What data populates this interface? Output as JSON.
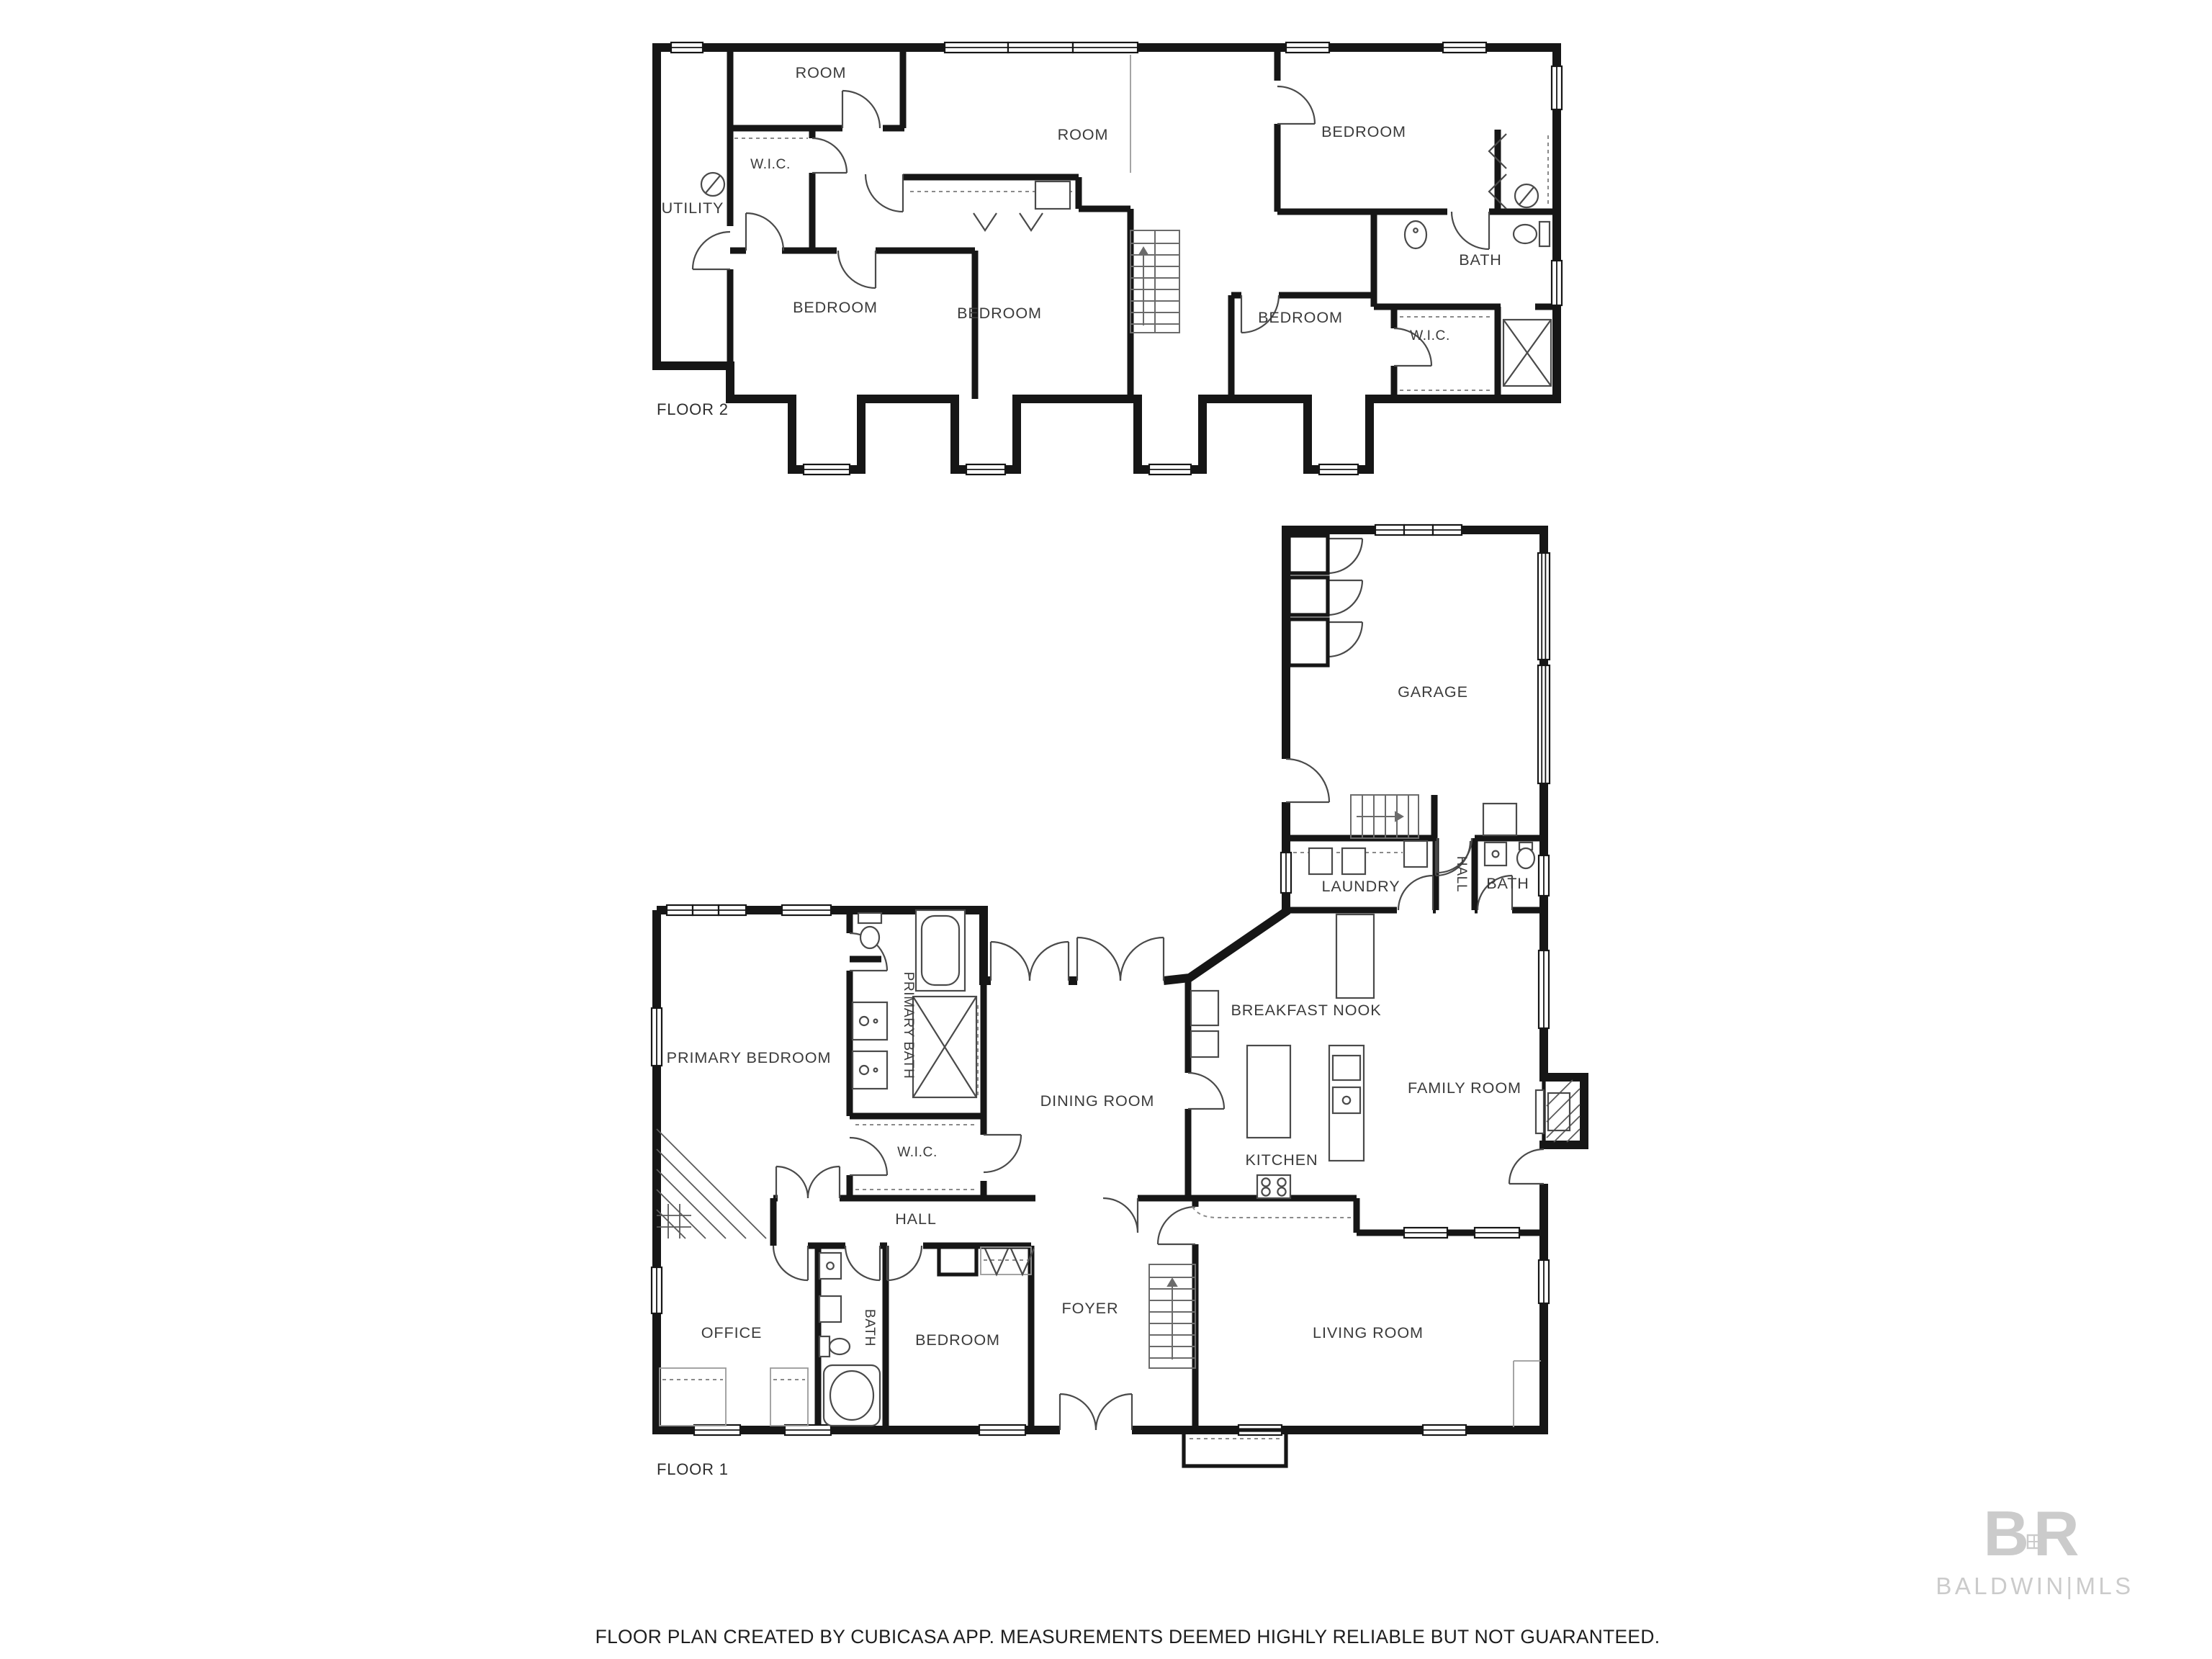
{
  "document": {
    "type": "floor-plan",
    "creator_note": "FLOOR PLAN CREATED BY CUBICASA APP. MEASUREMENTS DEEMED HIGHLY RELIABLE BUT NOT GUARANTEED."
  },
  "colors": {
    "background": "#ffffff",
    "wall": "#161616",
    "label": "#3b3b3b",
    "watermark": "#cbcbcb"
  },
  "floor2": {
    "label": "FLOOR 2",
    "rooms": {
      "utility": "UTILITY",
      "wic_left": "W.I.C.",
      "room_small": "ROOM",
      "room_center": "ROOM",
      "bedroom_top": "BEDROOM",
      "bath": "BATH",
      "wic_right": "W.I.C.",
      "bedroom_left": "BEDROOM",
      "bedroom_middle": "BEDROOM",
      "bedroom_right": "BEDROOM"
    }
  },
  "floor1": {
    "label": "FLOOR 1",
    "rooms": {
      "garage": "GARAGE",
      "laundry": "LAUNDRY",
      "hall_upper": "HALL",
      "bath_upper": "BATH",
      "breakfast_nook": "BREAKFAST NOOK",
      "family_room": "FAMILY ROOM",
      "dining_room": "DINING ROOM",
      "kitchen": "KITCHEN",
      "primary_bedroom": "PRIMARY BEDROOM",
      "primary_bath": "PRIMARY BATH",
      "wic": "W.I.C.",
      "hall": "HALL",
      "office": "OFFICE",
      "bath": "BATH",
      "bedroom": "BEDROOM",
      "foyer": "FOYER",
      "living_room": "LIVING ROOM"
    }
  },
  "footer": {
    "disclaimer": "FLOOR PLAN CREATED BY CUBICASA APP. MEASUREMENTS DEEMED HIGHLY RELIABLE BUT NOT GUARANTEED."
  },
  "watermark": {
    "monogram": "BR",
    "text": "BALDWIN|MLS"
  }
}
